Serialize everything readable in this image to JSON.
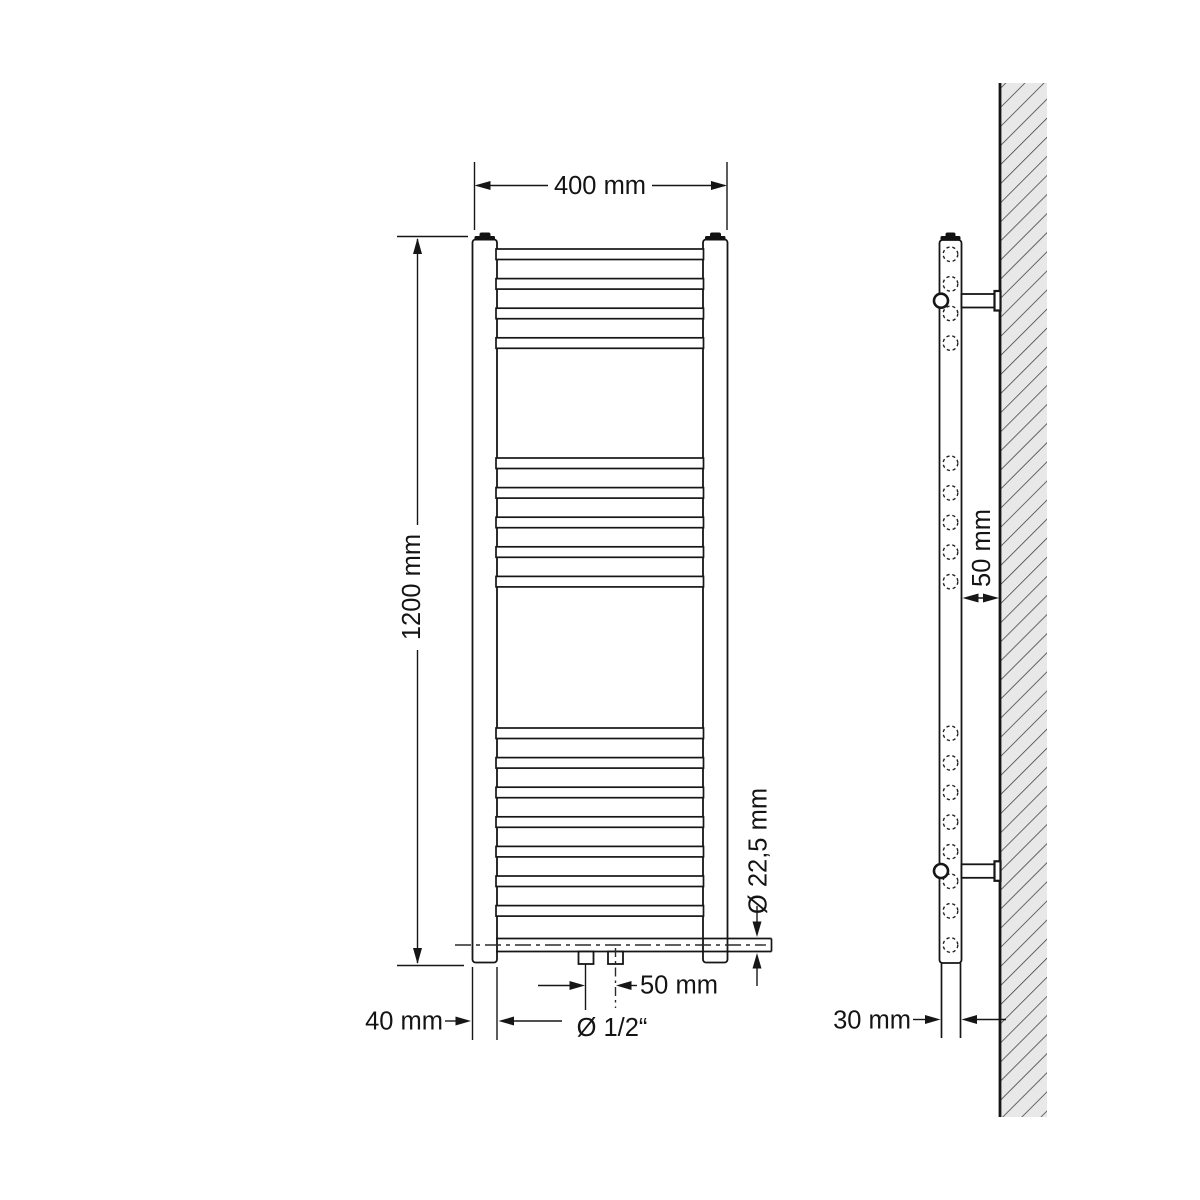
{
  "diagram": {
    "type": "technical-dimension-drawing",
    "subject": "bathroom towel radiator, front view and side wall-mount view",
    "labels": {
      "front_width": "400 mm",
      "front_height": "1200 mm",
      "column_width": "40 mm",
      "connection_spacing": "50 mm",
      "connection_size": "Ø 1/2“",
      "rung_diameter": "Ø 22,5 mm",
      "side_wall_distance": "50 mm",
      "side_tube_width": "30 mm"
    },
    "figure": {
      "line_color": "#161616",
      "wall_fill": "#e8e8e8",
      "rung_x": 496,
      "rung_width": 207.5,
      "rung_height": 10.5,
      "rung_pitch": 29.6,
      "rung_groups": [
        {
          "start_y": 249,
          "count": 4
        },
        {
          "start_y": 458,
          "count": 5
        },
        {
          "start_y": 728,
          "count": 7
        }
      ],
      "collector_y": 938.5,
      "collector_height": 13,
      "side_circle_cx": 950.5,
      "side_circle_r": 7.3
    }
  }
}
